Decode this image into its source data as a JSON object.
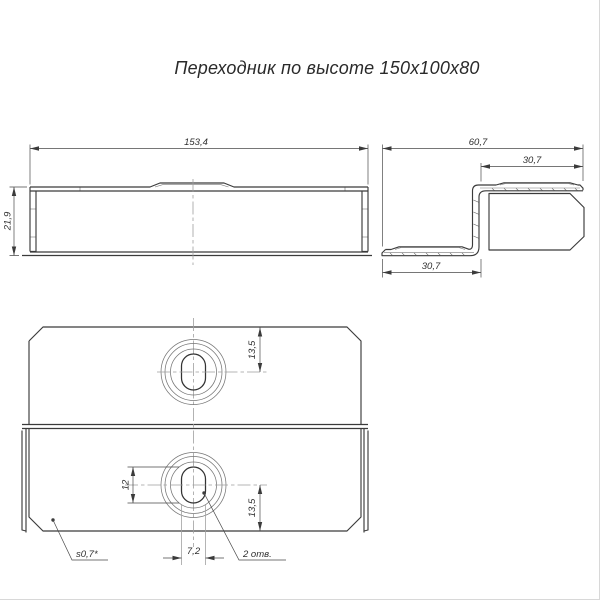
{
  "title": "Переходник по высоте 150х100х80",
  "colors": {
    "line": "#3b3b3b",
    "thin_line": "#787878",
    "background": "#ffffff"
  },
  "side_view": {
    "length": "153,4",
    "height": "21,9"
  },
  "end_view": {
    "width_total": "60,7",
    "flange_top": "30,7",
    "flange_bottom": "30,7"
  },
  "plan_view": {
    "hole_top_offset": "13,5",
    "slot_length": "12",
    "hole_bottom_offset": "13,5",
    "slot_width": "7,2",
    "holes_note": "2 отв.",
    "thickness_note": "s0,7*"
  }
}
